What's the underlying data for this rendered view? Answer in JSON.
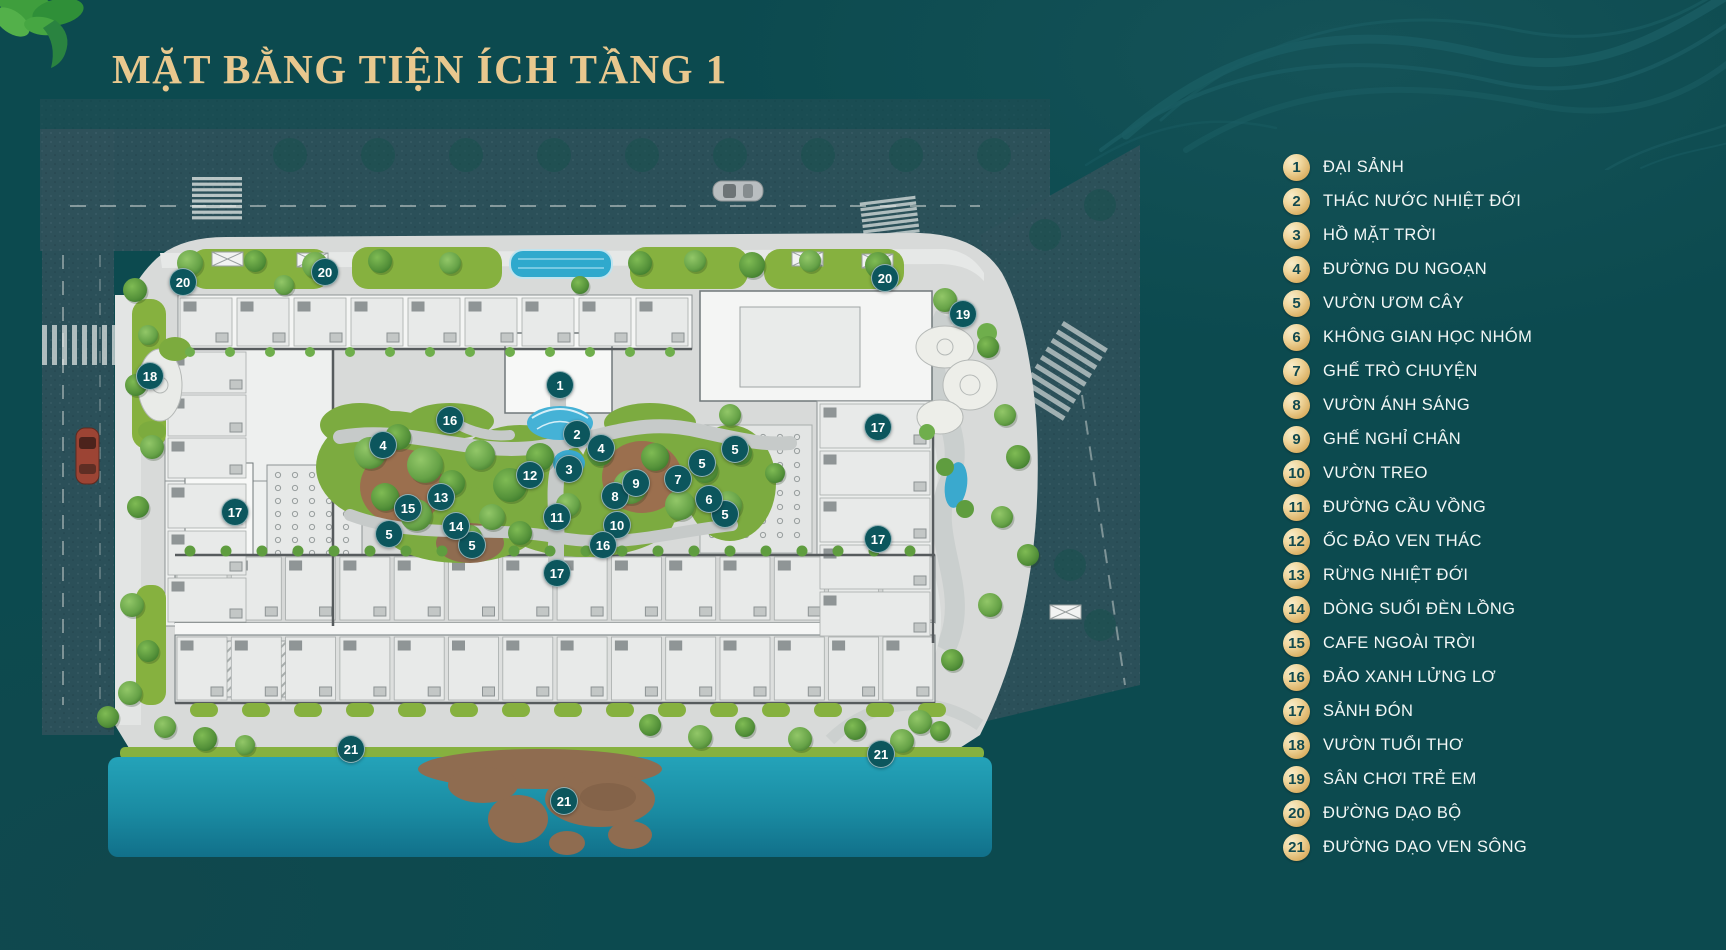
{
  "page": {
    "title": "MẶT BẰNG TIỆN ÍCH TẦNG 1"
  },
  "colors": {
    "background": "#0c4a4f",
    "title_gold": "#e9c88e",
    "legend_badge_gold": "#e3bc74",
    "legend_badge_number": "#12494e",
    "legend_text": "#f2f7f6",
    "plan_marker": "#0c565d",
    "river": "#1d95ab",
    "pool": "#35abce",
    "grass": "#86b13f",
    "pavement": "#d8dad9",
    "building": "#f4f5f4",
    "mulch": "#9b6f4e"
  },
  "legend": {
    "items": [
      {
        "n": "1",
        "label": "ĐẠI SẢNH"
      },
      {
        "n": "2",
        "label": "THÁC NƯỚC NHIỆT ĐỚI"
      },
      {
        "n": "3",
        "label": "HỒ MẶT TRỜI"
      },
      {
        "n": "4",
        "label": "ĐƯỜNG DU NGOẠN"
      },
      {
        "n": "5",
        "label": "VƯỜN ƯƠM CÂY"
      },
      {
        "n": "6",
        "label": "KHÔNG GIAN HỌC NHÓM"
      },
      {
        "n": "7",
        "label": "GHẾ TRÒ CHUYỆN"
      },
      {
        "n": "8",
        "label": "VƯỜN ÁNH SÁNG"
      },
      {
        "n": "9",
        "label": "GHẾ NGHỈ CHÂN"
      },
      {
        "n": "10",
        "label": "VƯỜN TREO"
      },
      {
        "n": "11",
        "label": "ĐƯỜNG CẦU VỒNG"
      },
      {
        "n": "12",
        "label": "ỐC ĐẢO VEN THÁC"
      },
      {
        "n": "13",
        "label": "RỪNG NHIỆT ĐỚI"
      },
      {
        "n": "14",
        "label": "DÒNG SUỐI ĐÈN LỒNG"
      },
      {
        "n": "15",
        "label": "CAFE NGOÀI TRỜI"
      },
      {
        "n": "16",
        "label": "ĐẢO XANH LỬNG LƠ"
      },
      {
        "n": "17",
        "label": "SẢNH ĐÓN"
      },
      {
        "n": "18",
        "label": "VƯỜN TUỔI THƠ"
      },
      {
        "n": "19",
        "label": "SÂN CHƠI TRẺ EM"
      },
      {
        "n": "20",
        "label": "ĐƯỜNG DẠO BỘ"
      },
      {
        "n": "21",
        "label": "ĐƯỜNG DẠO VEN SÔNG"
      }
    ]
  },
  "plan": {
    "markers": [
      {
        "n": "1",
        "x": 519,
        "y": 299
      },
      {
        "n": "2",
        "x": 536,
        "y": 348
      },
      {
        "n": "3",
        "x": 528,
        "y": 383
      },
      {
        "n": "4",
        "x": 342,
        "y": 359
      },
      {
        "n": "4",
        "x": 560,
        "y": 362
      },
      {
        "n": "5",
        "x": 694,
        "y": 363
      },
      {
        "n": "5",
        "x": 661,
        "y": 377
      },
      {
        "n": "5",
        "x": 348,
        "y": 448
      },
      {
        "n": "5",
        "x": 684,
        "y": 428
      },
      {
        "n": "5",
        "x": 431,
        "y": 459
      },
      {
        "n": "6",
        "x": 668,
        "y": 413
      },
      {
        "n": "7",
        "x": 637,
        "y": 393
      },
      {
        "n": "8",
        "x": 574,
        "y": 410
      },
      {
        "n": "9",
        "x": 595,
        "y": 397
      },
      {
        "n": "10",
        "x": 576,
        "y": 439
      },
      {
        "n": "11",
        "x": 516,
        "y": 431
      },
      {
        "n": "12",
        "x": 489,
        "y": 389
      },
      {
        "n": "13",
        "x": 400,
        "y": 411
      },
      {
        "n": "14",
        "x": 415,
        "y": 440
      },
      {
        "n": "15",
        "x": 367,
        "y": 422
      },
      {
        "n": "16",
        "x": 409,
        "y": 334
      },
      {
        "n": "16",
        "x": 562,
        "y": 459
      },
      {
        "n": "17",
        "x": 194,
        "y": 426
      },
      {
        "n": "17",
        "x": 837,
        "y": 341
      },
      {
        "n": "17",
        "x": 837,
        "y": 453
      },
      {
        "n": "17",
        "x": 516,
        "y": 487
      },
      {
        "n": "18",
        "x": 109,
        "y": 290
      },
      {
        "n": "19",
        "x": 922,
        "y": 228
      },
      {
        "n": "20",
        "x": 142,
        "y": 196
      },
      {
        "n": "20",
        "x": 284,
        "y": 186
      },
      {
        "n": "20",
        "x": 844,
        "y": 192
      },
      {
        "n": "21",
        "x": 310,
        "y": 663
      },
      {
        "n": "21",
        "x": 840,
        "y": 668
      },
      {
        "n": "21",
        "x": 523,
        "y": 715
      }
    ]
  }
}
